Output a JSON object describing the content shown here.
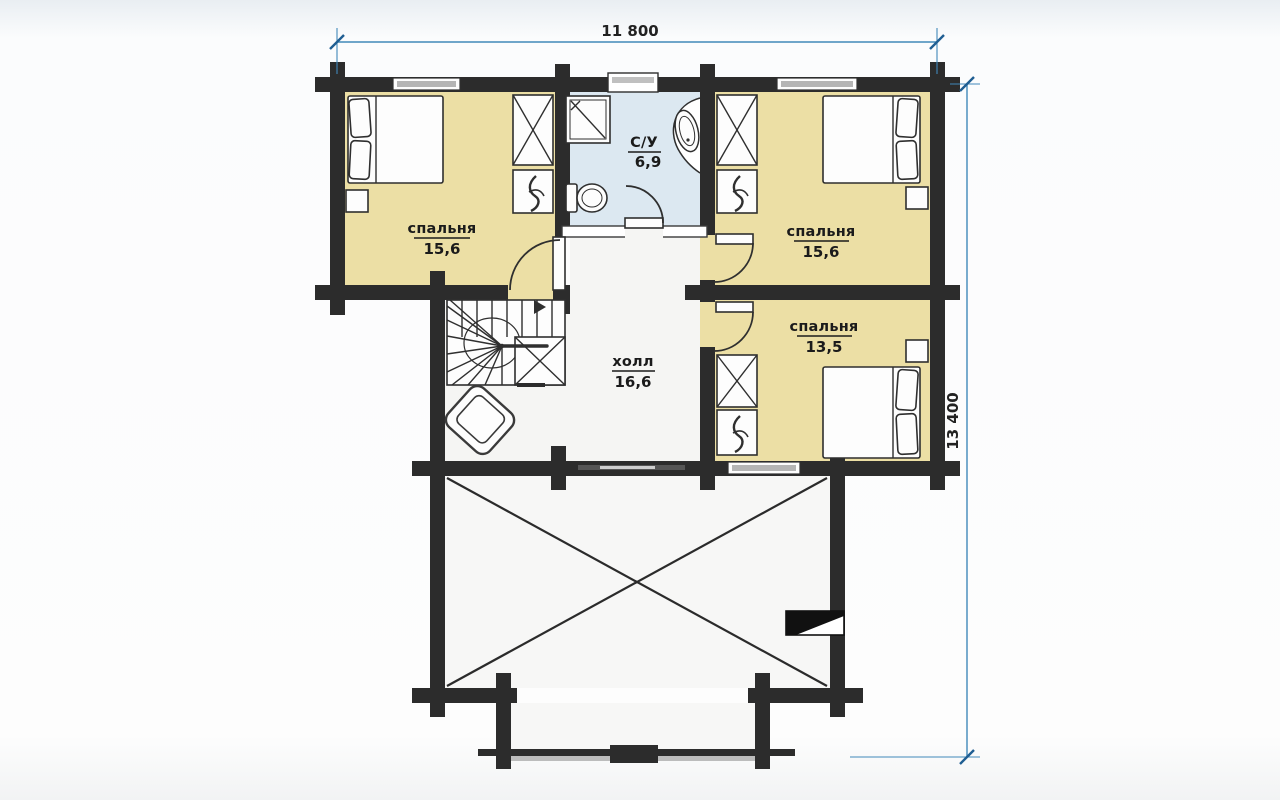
{
  "title": "Floor plan — second floor (план этажа)",
  "dimensions": {
    "top": {
      "label": "11 800"
    },
    "right": {
      "label": "13 400"
    }
  },
  "rooms": {
    "bedroom_left": {
      "name": "спальня",
      "area": "15,6"
    },
    "bathroom": {
      "name": "С/У",
      "area": "6,9"
    },
    "bedroom_right_top": {
      "name": "спальня",
      "area": "15,6"
    },
    "bedroom_right_bottom": {
      "name": "спальня",
      "area": "13,5"
    },
    "hall": {
      "name": "холл",
      "area": "16,6"
    }
  },
  "colors": {
    "wall": "#2c2c2c",
    "bedroom_floor": "#ecdfa5",
    "bathroom_floor": "#dce8f1",
    "hall_floor": "#f5f5f3",
    "void_floor": "#f7f7f6",
    "window_glass": "#b5b5b5",
    "dimension_line": "#4189ba",
    "dimension_tick": "#1f5e92",
    "label_text": "#1b1b1b"
  }
}
